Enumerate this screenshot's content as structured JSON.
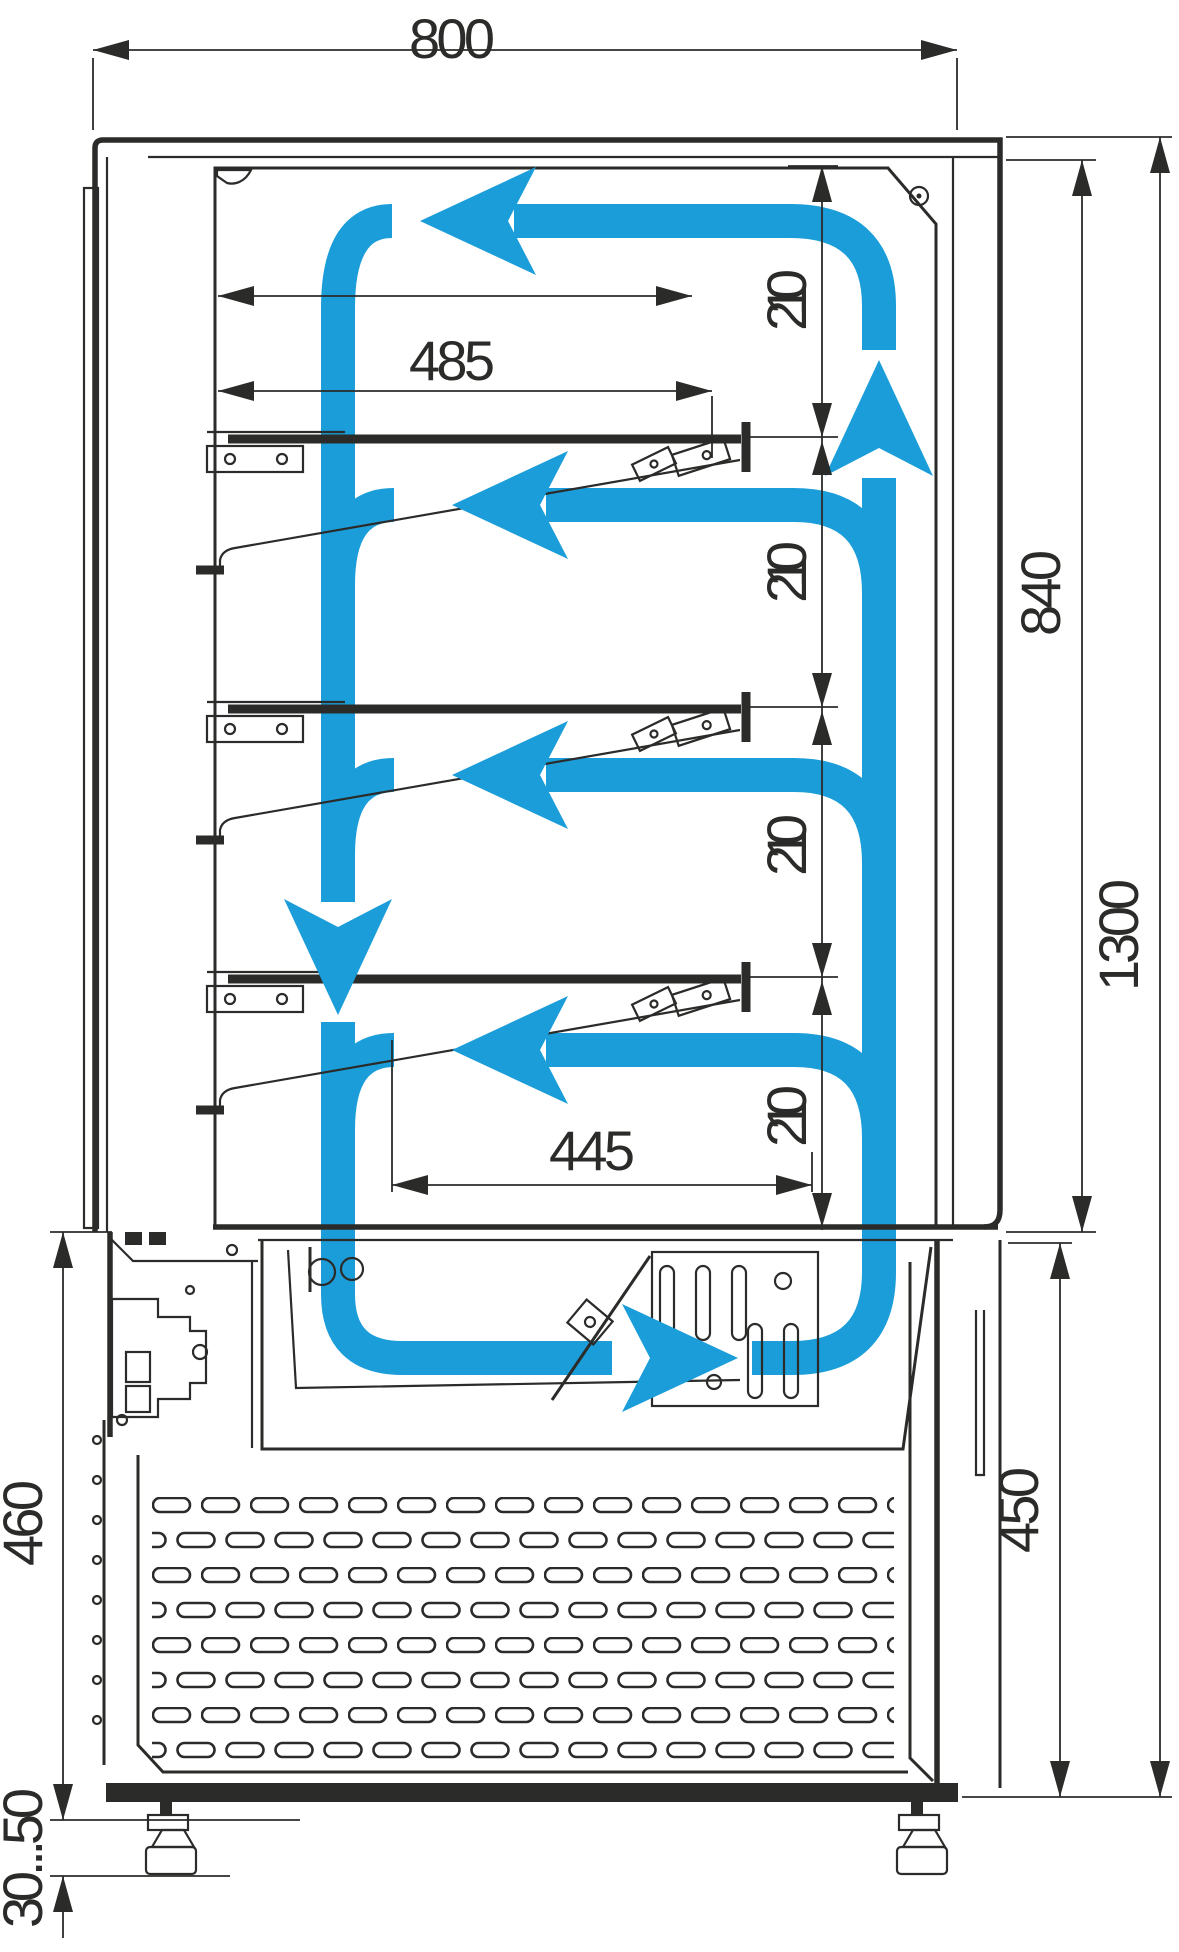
{
  "title": "Refrigerated pastry display case - cross-section with air circulation",
  "units": "mm",
  "colors": {
    "line": "#2b2b29",
    "airflow": "#1b9dd9",
    "background": "#ffffff"
  },
  "dims": {
    "overall_width": "800",
    "shelf_depth": "485",
    "level_gap_1": "210",
    "level_gap_2": "210",
    "level_gap_3": "210",
    "level_gap_4": "210",
    "display_interior_height": "840",
    "overall_height": "1300",
    "well_depth": "445",
    "machine_section_height": "450",
    "base_height": "460",
    "foot_adjustment_range": "30...50"
  },
  "airflow": {
    "color": "#1b9dd9",
    "arrow_count": 8,
    "arrows": [
      "top-duct-flow-left",
      "gap2-flow-left",
      "gap3-flow-left",
      "gap4-flow-left",
      "front-column-down",
      "well-flow-right",
      "rear-column-up"
    ]
  },
  "structure": {
    "shelf_count": 3,
    "grille": "ventilation-grille",
    "feet": 2
  }
}
